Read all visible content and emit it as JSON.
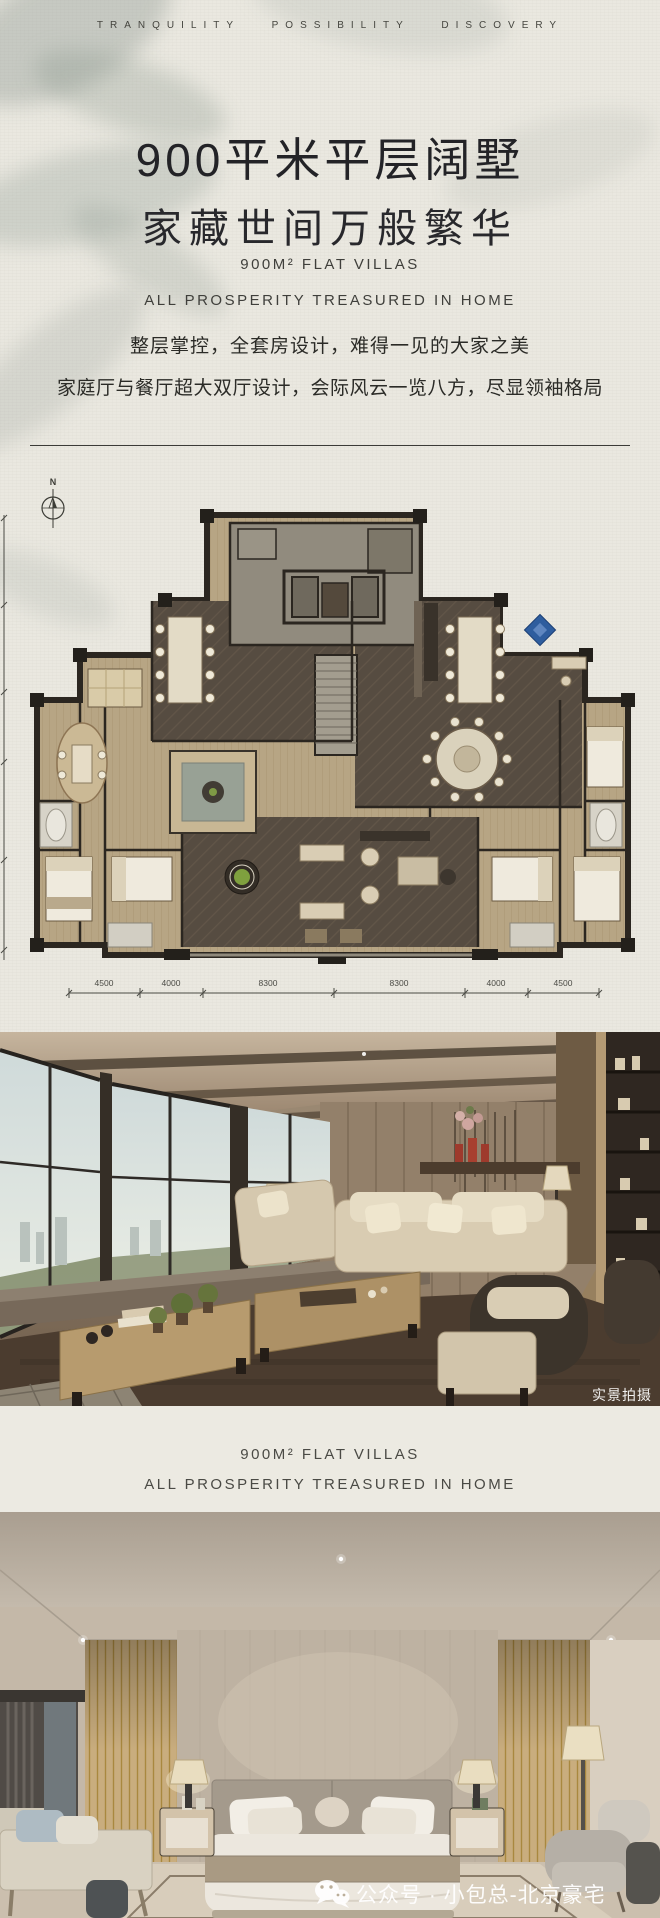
{
  "header": {
    "tagline": "TRANQUILITY POSSIBILITY DISCOVERY"
  },
  "hero": {
    "title_line1": "900平米平层阔墅",
    "title_line2": "家藏世间万般繁华",
    "subtitle_line1": "900M² FLAT VILLAS",
    "subtitle_line2": "ALL PROSPERITY TREASURED IN HOME",
    "body_line1": "整层掌控，全套房设计，难得一见的大家之美",
    "body_line2": "家庭厅与餐厅超大双厅设计，会际风云一览八方，尽显领袖格局"
  },
  "floor_plan": {
    "compass_label": "N",
    "dimension_labels": [
      "4500",
      "4000",
      "8300",
      "8300",
      "4000",
      "4500"
    ]
  },
  "living_photo": {
    "watermark": "实景拍摄"
  },
  "mid_band": {
    "subtitle_line1": "900M² FLAT VILLAS",
    "subtitle_line2": "ALL PROSPERITY TREASURED IN HOME"
  },
  "bedroom_photo": {
    "watermark": "公众号 · 小包总-北京豪宅"
  },
  "colors": {
    "paper": "#eae8e0",
    "ink": "#2c2c28",
    "plan_wood": "#b7a584",
    "plan_dark_floor": "#544a3f",
    "plan_wall": "#2b2620",
    "accent_blue_rug": "#2e5d9e"
  }
}
